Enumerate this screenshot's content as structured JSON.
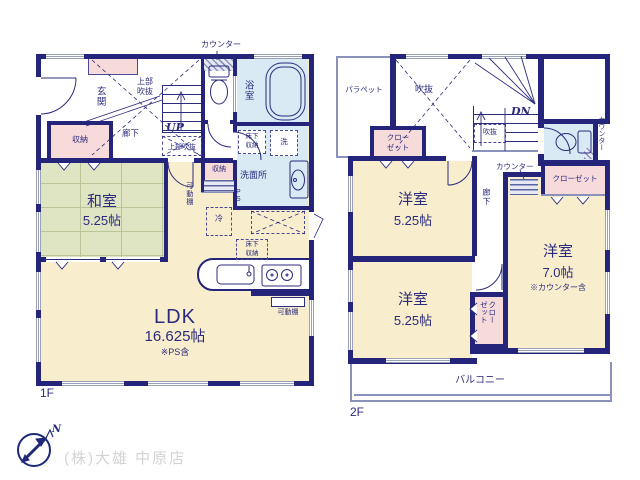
{
  "meta": {
    "floor1": "1F",
    "floor2": "2F"
  },
  "footer": {
    "company": "(株)大雄 中原店",
    "north": "N"
  },
  "f1": {
    "counter": "カウンター",
    "genkan": "玄関",
    "void_upper_a": "上部",
    "void_upper_b": "吹抜",
    "hall": "廊下",
    "up": "UP",
    "void_upper2": "上部吹抜",
    "bath": "浴室",
    "underfloor_a": "床下",
    "underfloor_b": "収納",
    "washer": "洗",
    "washroom": "洗面所",
    "ps": "PS",
    "storage_hall": "収納",
    "shelf_v": "可動棚",
    "fridge": "冷",
    "underfloor2_a": "床下",
    "underfloor2_b": "収納",
    "shelf_b": "可動棚",
    "storage_left": "収納",
    "washitsu": "和室",
    "washitsu_size": "5.25帖",
    "ldk": "LDK",
    "ldk_size": "16.625帖",
    "ldk_note": "※PS含"
  },
  "f2": {
    "parapet": "パラペット",
    "void": "吹抜",
    "dn": "DN",
    "void_small": "吹抜",
    "closet1_a": "クロー",
    "closet1_b": "ゼット",
    "counter_r": "カウンター",
    "counter_m": "カウンター",
    "closet2": "クローゼット",
    "hall": "廊下",
    "room1": "洋室",
    "room1_size": "5.25帖",
    "room2": "洋室",
    "room2_size": "5.25帖",
    "room3": "洋室",
    "room3_size": "7.0帖",
    "room3_note": "※カウンター含",
    "closet3_a": "クロー",
    "closet3_b": "ゼット",
    "balcony": "バルコニー"
  }
}
